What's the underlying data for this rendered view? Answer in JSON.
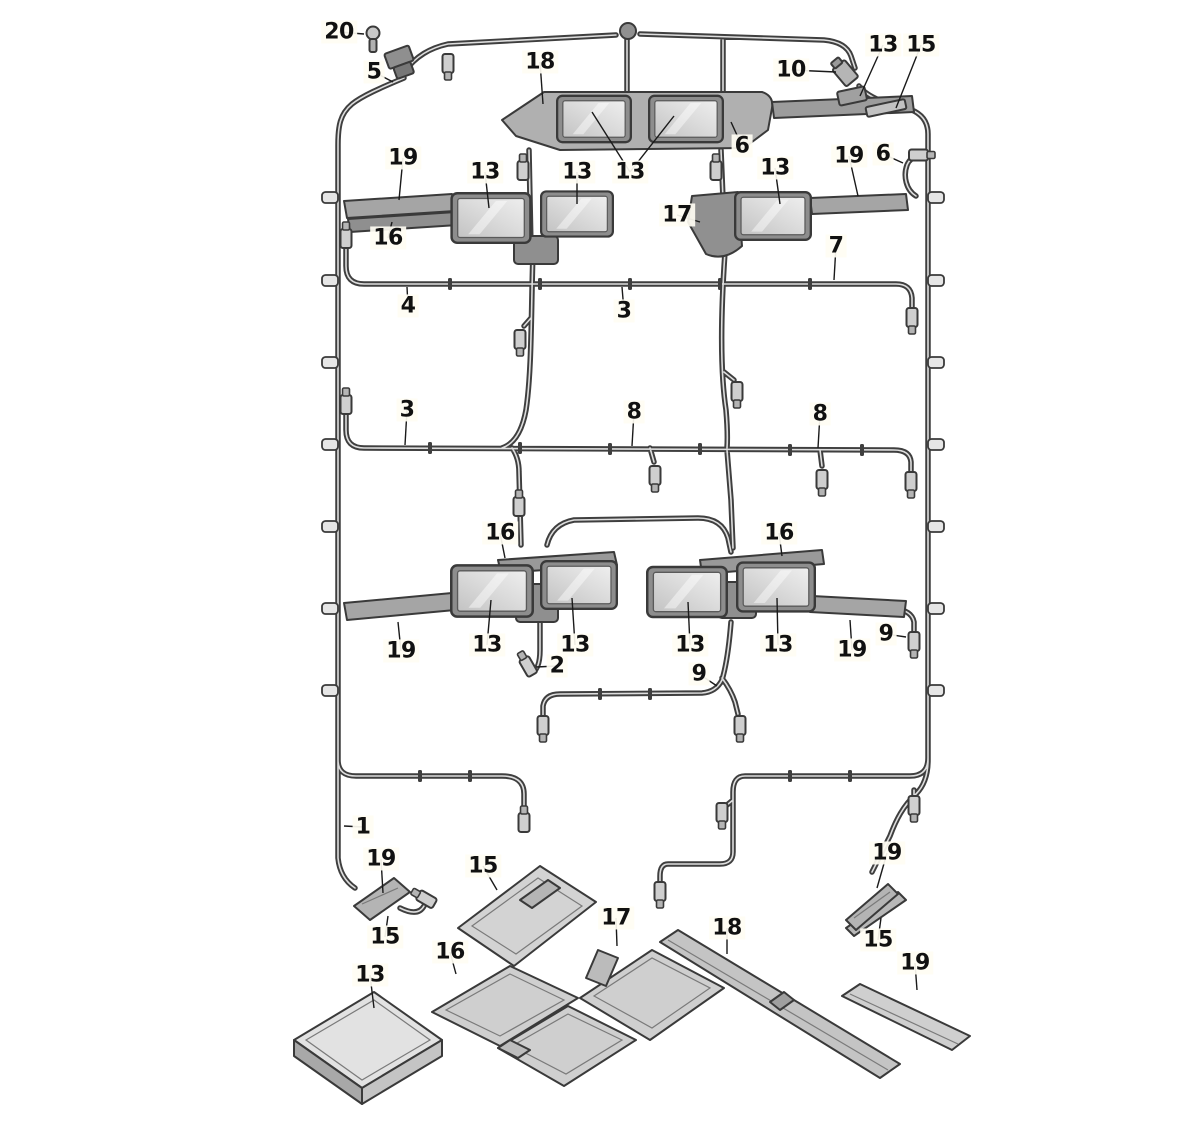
{
  "figure": {
    "kind": "exploded-parts-diagram",
    "background_color": "#ffffff",
    "wire_color": "#3f3f3f",
    "wire_highlight_color": "#dedede",
    "module_fill": "#d8d8d8",
    "bracket_fill": "#a8a8a8",
    "callout_text_color": "#111111",
    "leader_line_color": "#1a1a1a"
  },
  "icons": [
    {
      "name": "bolt-icon",
      "label_ref": "20"
    },
    {
      "name": "connector-icon",
      "label_ref": "5"
    },
    {
      "name": "grommet-icon",
      "label_ref": ""
    }
  ],
  "callouts": [
    {
      "label": "20",
      "x": 339,
      "y": 32,
      "targets": [
        [
          364,
          34
        ]
      ]
    },
    {
      "label": "5",
      "x": 374,
      "y": 72,
      "targets": [
        [
          393,
          82
        ]
      ]
    },
    {
      "label": "18",
      "x": 540,
      "y": 62,
      "targets": [
        [
          543,
          104
        ]
      ]
    },
    {
      "label": "13",
      "x": 630,
      "y": 172,
      "targets": [
        [
          592,
          112
        ],
        [
          674,
          116
        ]
      ]
    },
    {
      "label": "10",
      "x": 791,
      "y": 70,
      "targets": [
        [
          836,
          72
        ]
      ]
    },
    {
      "label": "13",
      "x": 883,
      "y": 45,
      "targets": [
        [
          860,
          96
        ]
      ]
    },
    {
      "label": "15",
      "x": 921,
      "y": 45,
      "targets": [
        [
          896,
          108
        ]
      ]
    },
    {
      "label": "6",
      "x": 742,
      "y": 146,
      "targets": [
        [
          731,
          122
        ]
      ]
    },
    {
      "label": "6",
      "x": 883,
      "y": 154,
      "targets": [
        [
          903,
          163
        ]
      ]
    },
    {
      "label": "19",
      "x": 849,
      "y": 156,
      "targets": [
        [
          858,
          196
        ]
      ]
    },
    {
      "label": "13",
      "x": 775,
      "y": 168,
      "targets": [
        [
          780,
          204
        ]
      ]
    },
    {
      "label": "17",
      "x": 677,
      "y": 215,
      "targets": [
        [
          700,
          222
        ]
      ]
    },
    {
      "label": "19",
      "x": 403,
      "y": 158,
      "targets": [
        [
          399,
          200
        ]
      ]
    },
    {
      "label": "13",
      "x": 485,
      "y": 172,
      "targets": [
        [
          489,
          208
        ]
      ]
    },
    {
      "label": "13",
      "x": 577,
      "y": 172,
      "targets": [
        [
          577,
          204
        ]
      ]
    },
    {
      "label": "16",
      "x": 388,
      "y": 238,
      "targets": [
        [
          392,
          222
        ]
      ]
    },
    {
      "label": "7",
      "x": 836,
      "y": 246,
      "targets": [
        [
          834,
          280
        ]
      ]
    },
    {
      "label": "4",
      "x": 408,
      "y": 306,
      "targets": [
        [
          407,
          287
        ]
      ]
    },
    {
      "label": "3",
      "x": 624,
      "y": 311,
      "targets": [
        [
          622,
          287
        ]
      ]
    },
    {
      "label": "3",
      "x": 407,
      "y": 410,
      "targets": [
        [
          405,
          445
        ]
      ]
    },
    {
      "label": "8",
      "x": 634,
      "y": 412,
      "targets": [
        [
          632,
          446
        ]
      ]
    },
    {
      "label": "8",
      "x": 820,
      "y": 414,
      "targets": [
        [
          818,
          448
        ]
      ]
    },
    {
      "label": "16",
      "x": 500,
      "y": 533,
      "targets": [
        [
          505,
          558
        ]
      ]
    },
    {
      "label": "16",
      "x": 779,
      "y": 533,
      "targets": [
        [
          782,
          556
        ]
      ]
    },
    {
      "label": "19",
      "x": 401,
      "y": 651,
      "targets": [
        [
          398,
          622
        ]
      ]
    },
    {
      "label": "13",
      "x": 487,
      "y": 645,
      "targets": [
        [
          491,
          600
        ]
      ]
    },
    {
      "label": "13",
      "x": 575,
      "y": 645,
      "targets": [
        [
          572,
          598
        ]
      ]
    },
    {
      "label": "2",
      "x": 557,
      "y": 666,
      "targets": [
        [
          536,
          667
        ]
      ]
    },
    {
      "label": "13",
      "x": 690,
      "y": 645,
      "targets": [
        [
          688,
          602
        ]
      ]
    },
    {
      "label": "13",
      "x": 778,
      "y": 645,
      "targets": [
        [
          777,
          598
        ]
      ]
    },
    {
      "label": "19",
      "x": 852,
      "y": 650,
      "targets": [
        [
          850,
          620
        ]
      ]
    },
    {
      "label": "9",
      "x": 886,
      "y": 634,
      "targets": [
        [
          906,
          637
        ]
      ]
    },
    {
      "label": "9",
      "x": 699,
      "y": 674,
      "targets": [
        [
          717,
          686
        ]
      ]
    },
    {
      "label": "1",
      "x": 363,
      "y": 827,
      "targets": [
        [
          344,
          826
        ]
      ]
    },
    {
      "label": "19",
      "x": 381,
      "y": 859,
      "targets": [
        [
          383,
          893
        ]
      ]
    },
    {
      "label": "15",
      "x": 385,
      "y": 937,
      "targets": [
        [
          388,
          916
        ]
      ]
    },
    {
      "label": "15",
      "x": 483,
      "y": 866,
      "targets": [
        [
          497,
          890
        ]
      ]
    },
    {
      "label": "16",
      "x": 450,
      "y": 952,
      "targets": [
        [
          456,
          974
        ]
      ]
    },
    {
      "label": "13",
      "x": 370,
      "y": 975,
      "targets": [
        [
          374,
          1008
        ]
      ]
    },
    {
      "label": "17",
      "x": 616,
      "y": 918,
      "targets": [
        [
          617,
          946
        ]
      ]
    },
    {
      "label": "18",
      "x": 727,
      "y": 928,
      "targets": [
        [
          727,
          954
        ]
      ]
    },
    {
      "label": "19",
      "x": 887,
      "y": 853,
      "targets": [
        [
          877,
          888
        ]
      ]
    },
    {
      "label": "15",
      "x": 878,
      "y": 940,
      "targets": [
        [
          881,
          918
        ]
      ]
    },
    {
      "label": "19",
      "x": 915,
      "y": 963,
      "targets": [
        [
          917,
          990
        ]
      ]
    }
  ]
}
